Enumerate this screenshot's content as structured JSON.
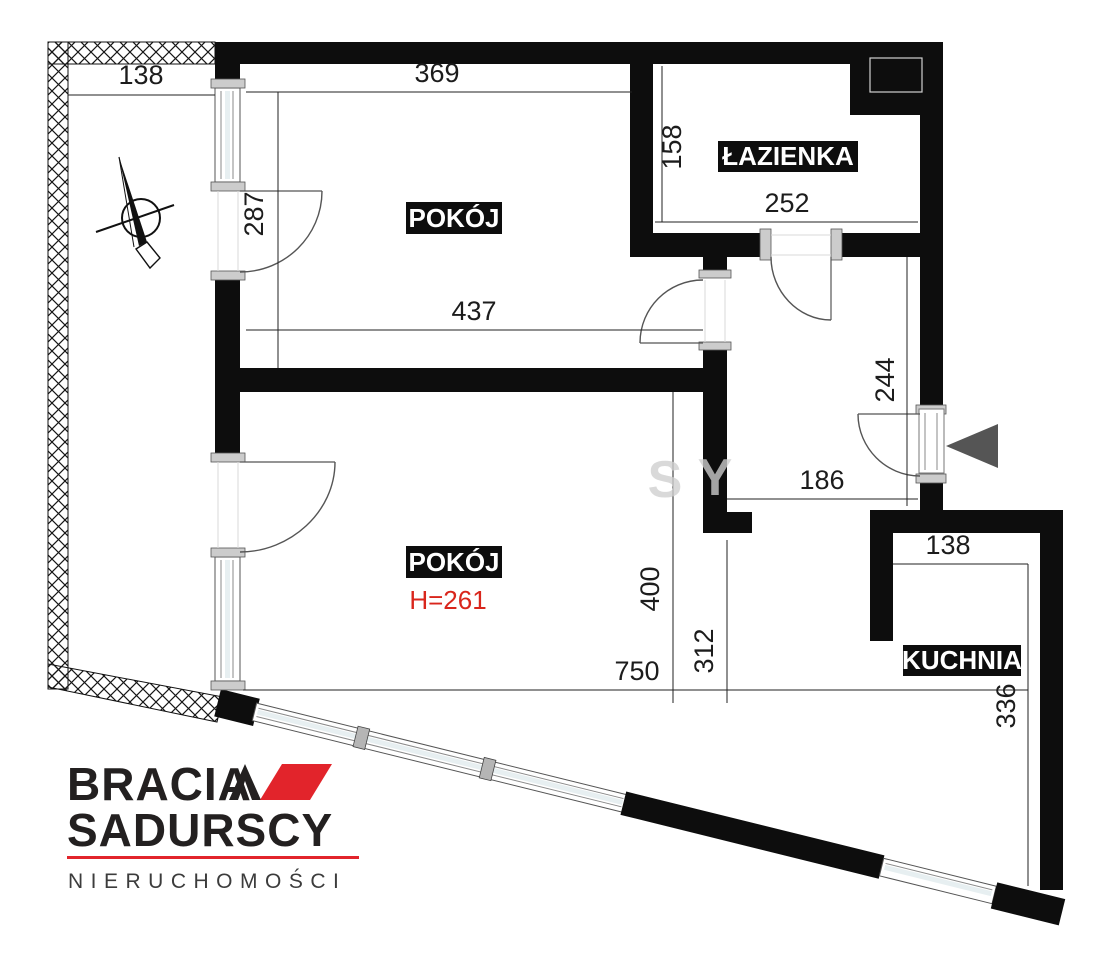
{
  "plan": {
    "rooms": [
      {
        "label": "POKÓJ"
      },
      {
        "label": "ŁAZIENKA"
      },
      {
        "label": "POKÓJ",
        "height_note": "H=261"
      },
      {
        "label": "KUCHNIA"
      }
    ],
    "dimensions": {
      "balcony_width": "138",
      "room1_top_width": "369",
      "room1_height_left": "287",
      "bathroom_height": "158",
      "bathroom_width": "252",
      "room1_full_width": "437",
      "hall_height_right": "244",
      "hall_width_bottom": "186",
      "room2_height": "400",
      "passage_height": "312",
      "bottom_total_width": "750",
      "kitchen_top_width": "138",
      "kitchen_height": "336"
    }
  },
  "watermark": {
    "part1": "S",
    "part2": "Y"
  },
  "logo": {
    "brand_top": "BRACIA",
    "brand_bottom": "SADURSCY",
    "tagline": "NIERUCHOMOŚCI"
  },
  "colors": {
    "wall": "#0d0d0d",
    "accent_red": "#e2242b",
    "dim_red": "#d9261c"
  }
}
